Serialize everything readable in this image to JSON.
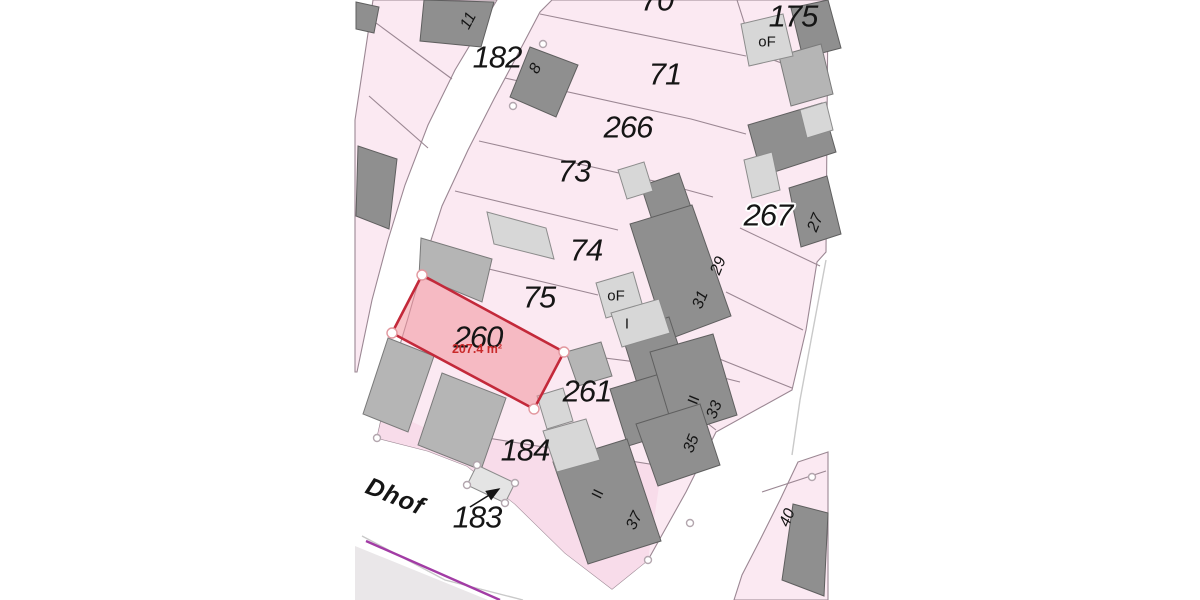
{
  "map": {
    "description": "Cadastral parcel map extract with one highlighted parcel",
    "highlight": {
      "parcel_number": "260",
      "area_label": "207.4 m²"
    },
    "street": {
      "name_fragment": "Dhof"
    },
    "labels": {
      "parcels": {
        "p182": "182",
        "p70": "70",
        "p175": "175",
        "p71": "71",
        "p266": "266",
        "p73": "73",
        "p267": "267",
        "p74": "74",
        "p75": "75",
        "p260": "260",
        "p261": "261",
        "p184": "184",
        "p183": "183"
      },
      "house_numbers": {
        "h8": "8",
        "h11": "11",
        "h27": "27",
        "h29": "29",
        "h31": "31",
        "h33": "33",
        "h35": "35",
        "h37": "37",
        "h40": "40"
      },
      "storeys": {
        "of_top": "oF",
        "of_mid": "oF",
        "roman_i": "I",
        "roman_ii_a": "II",
        "roman_ii_b": "II"
      }
    },
    "colors": {
      "parcel_fill": "#fbe9f2",
      "parcel_fill_deep": "#f8dcea",
      "boundary_line": "#9b8793",
      "street_fill": "#ffffff",
      "street_edge": "#c9c9c9",
      "building_dark": "#8f8f8f",
      "building_dark_stroke": "#5f5f5f",
      "building_medium": "#b5b5b5",
      "building_medium_stroke": "#7a7a7a",
      "building_light": "#d7d7d7",
      "building_light_stroke": "#8c8c8c",
      "parcel_183_fill": "#e4e4e4",
      "highlight_fill": "#f2949c",
      "highlight_stroke": "#c3293a",
      "vertex_red_stroke": "#e2989f",
      "vertex_gray_stroke": "#b3a6ae",
      "political_boundary": "#a23ca5",
      "area_text": "#c92a2a",
      "verge_fill": "#eae7e9"
    }
  }
}
